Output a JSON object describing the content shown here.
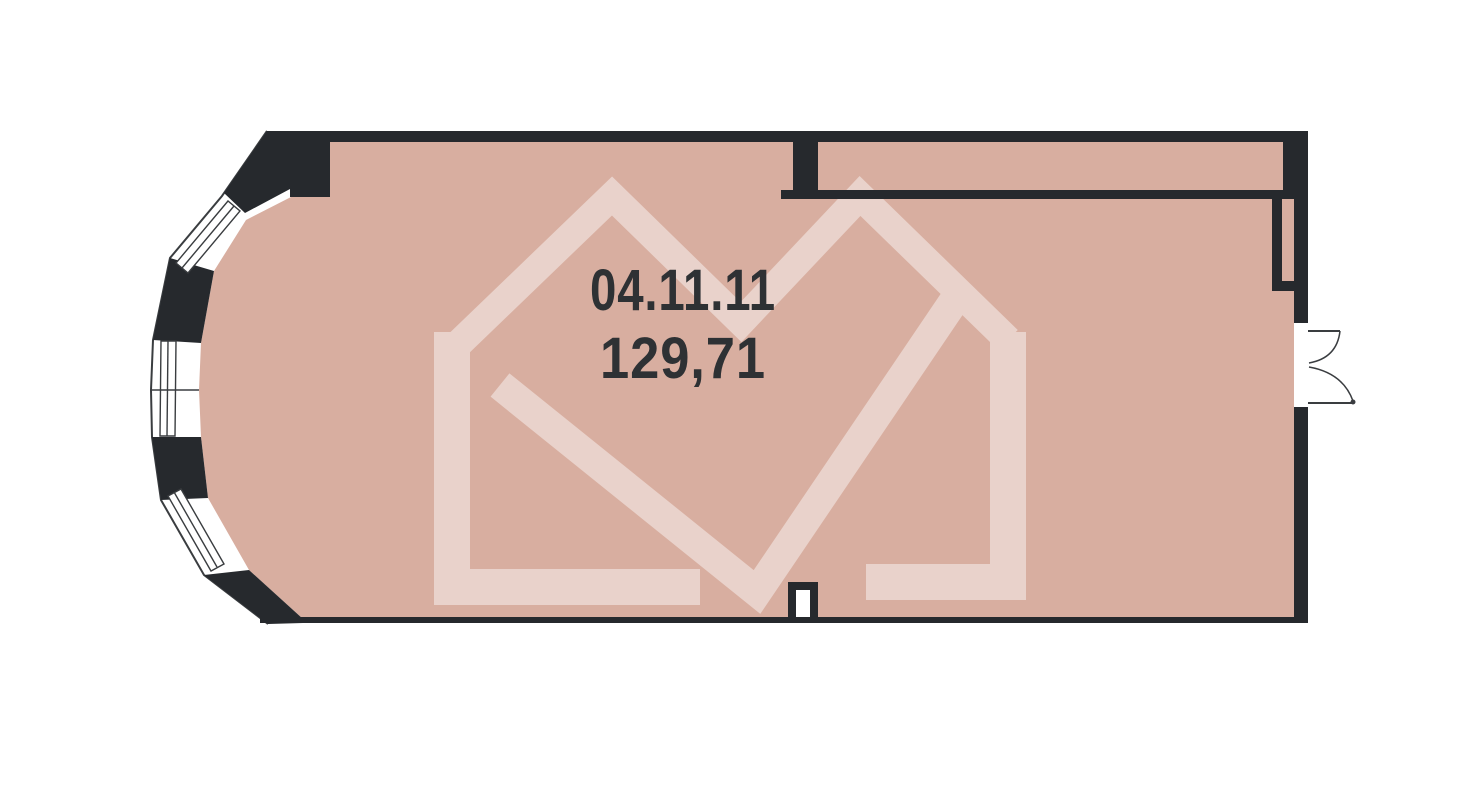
{
  "unit": {
    "number": "04.11.11",
    "area": "129,71"
  },
  "colors": {
    "floor": "#d8aea0",
    "wall": "#26292d",
    "outline": "#3a3d40",
    "watermark": "#ffffff",
    "paper": "#ffffff",
    "label": "#2e3134"
  }
}
